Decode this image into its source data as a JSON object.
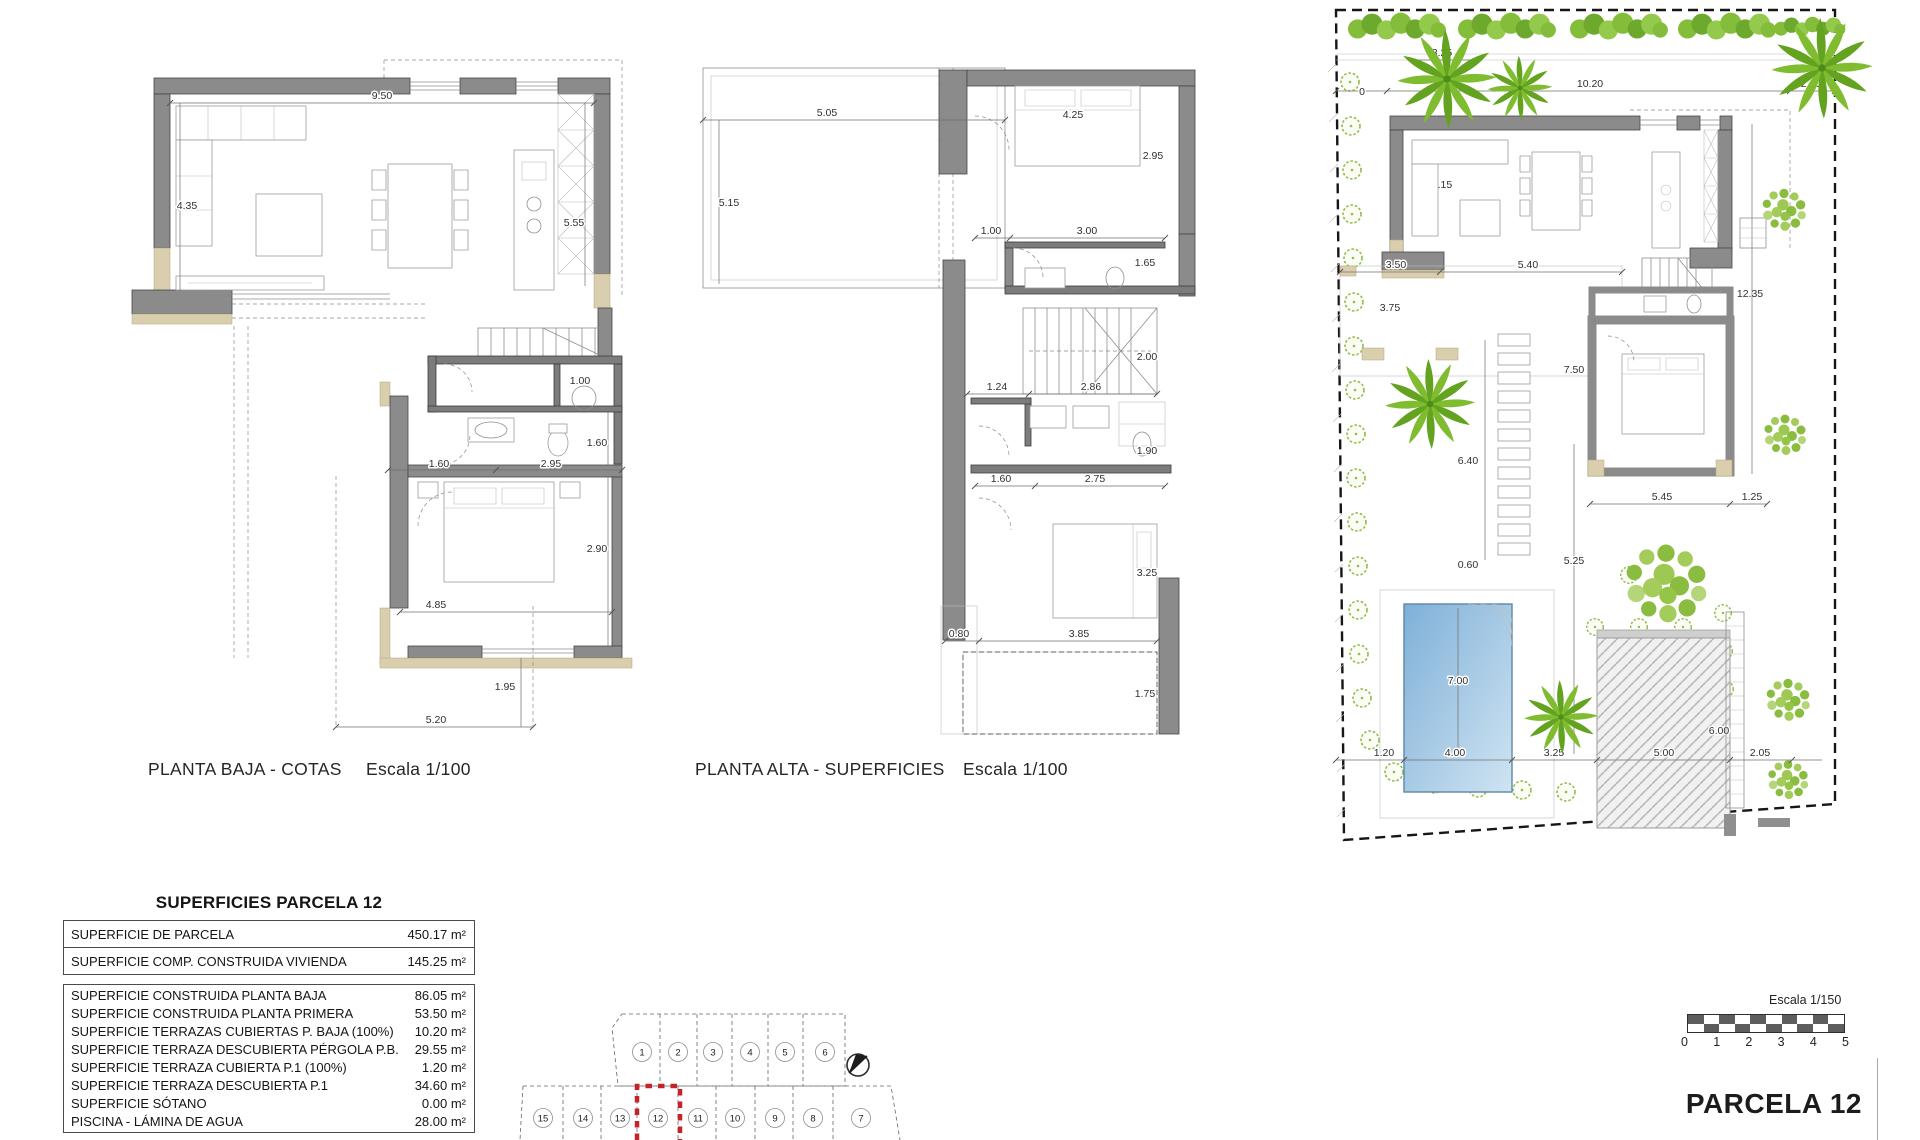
{
  "plans": {
    "baja": {
      "title": "PLANTA BAJA - COTAS",
      "scale": "Escala 1/100",
      "dims": [
        "9.50",
        "4.35",
        "5.55",
        "1.00",
        "1.60",
        "2.95",
        "1.60",
        "2.90",
        "4.85",
        "1.95",
        "5.20"
      ]
    },
    "alta": {
      "title": "PLANTA ALTA - SUPERFICIES",
      "scale": "Escala 1/100",
      "dims": [
        "5.05",
        "5.15",
        "4.25",
        "2.95",
        "1.00",
        "3.00",
        "1.65",
        "2.00",
        "1.24",
        "2.86",
        "1.90",
        "1.60",
        "2.75",
        "3.25",
        "0.80",
        "3.85",
        "1.75"
      ]
    },
    "site": {
      "parcel_label": "PARCELA 12",
      "scale_label": "Escala 1/150",
      "scale_ticks": [
        "0",
        "1",
        "2",
        "3",
        "4",
        "5"
      ],
      "dims": [
        "3.25",
        "0",
        "10.20",
        "2.20",
        "5.15",
        "3.50",
        "5.40",
        "3.75",
        "12.35",
        "7.50",
        "6.40",
        "0.60",
        "5.25",
        "5.45",
        "1.25",
        "7.00",
        "4.00",
        "1.20",
        "3.25",
        "5.00",
        "6.00",
        "2.05"
      ]
    }
  },
  "areas_table": {
    "title": "SUPERFICIES PARCELA 12",
    "group1": [
      {
        "label": "SUPERFICIE DE PARCELA",
        "value": "450.17 m²"
      },
      {
        "label": "SUPERFICIE COMP. CONSTRUIDA VIVIENDA",
        "value": "145.25 m²"
      }
    ],
    "group2": [
      {
        "label": "SUPERFICIE CONSTRUIDA PLANTA BAJA",
        "value": "86.05 m²"
      },
      {
        "label": "SUPERFICIE CONSTRUIDA PLANTA PRIMERA",
        "value": "53.50 m²"
      },
      {
        "label": "SUPERFICIE TERRAZAS CUBIERTAS P. BAJA (100%)",
        "value": "10.20 m²"
      },
      {
        "label": "SUPERFICIE TERRAZA DESCUBIERTA PÉRGOLA P.B.",
        "value": "29.55 m²"
      },
      {
        "label": "SUPERFICIE TERRAZA CUBIERTA P.1 (100%)",
        "value": "1.20 m²"
      },
      {
        "label": "SUPERFICIE TERRAZA DESCUBIERTA P.1",
        "value": "34.60 m²"
      },
      {
        "label": "SUPERFICIE SÓTANO",
        "value": "0.00 m²"
      },
      {
        "label": "PISCINA - LÁMINA DE AGUA",
        "value": "28.00 m²"
      }
    ],
    "group3": [
      {
        "label": "SUPERFICIE CONSTRUIDA TOTAL PROYECTO",
        "value": "243.10 m²"
      }
    ]
  },
  "parcels": {
    "top_row": [
      "1",
      "2",
      "3",
      "4",
      "5",
      "6"
    ],
    "bottom_row": [
      "15",
      "14",
      "13",
      "12",
      "11",
      "10",
      "9",
      "8",
      "7"
    ],
    "highlighted": "12"
  }
}
